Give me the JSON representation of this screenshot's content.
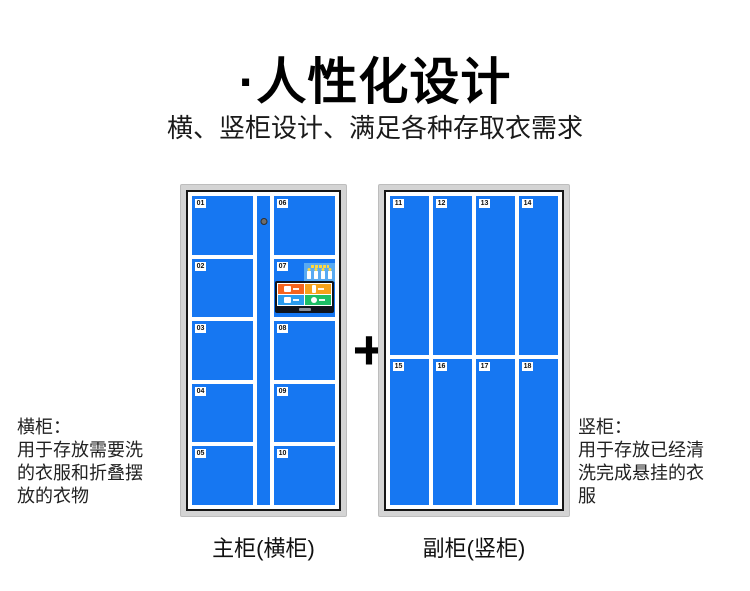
{
  "header": {
    "title": "·人性化设计",
    "subtitle": "横、竖柜设计、满足各种存取衣需求"
  },
  "plus_sign": "+",
  "main_cabinet": {
    "caption": "主柜(横柜)",
    "left_column_doors": [
      "01",
      "02",
      "03",
      "04",
      "05"
    ],
    "right_column_doors": [
      "06",
      "07",
      "08",
      "09",
      "10"
    ],
    "panel_door": "07"
  },
  "secondary_cabinet": {
    "caption": "副柜(竖柜)",
    "top_row_doors": [
      "11",
      "12",
      "13",
      "14"
    ],
    "bottom_row_doors": [
      "15",
      "16",
      "17",
      "18"
    ]
  },
  "annotations": {
    "left": {
      "heading": "横柜：",
      "lines": [
        "用于存放需要洗",
        "的衣服和折叠摆",
        "放的衣物"
      ]
    },
    "right": {
      "heading": "竖柜：",
      "lines": [
        "用于存放已经清",
        "洗完成悬挂的衣",
        "服"
      ]
    }
  },
  "icons": {
    "lock-icon": "dark round keyhole on center door column",
    "emergency-keys-icon": "four white key tags with yellow caps on blue panel",
    "gear-icon": "white gear dot on green screen tile",
    "plus-icon": "+"
  },
  "colors": {
    "door_blue": "#1677F2",
    "frame_gray": "#D4D4D4",
    "frame_border": "#161616",
    "key_panel_blue": "#58AAF2",
    "key_cap_yellow": "#FFD83D",
    "screen_bezel": "#10141C",
    "screen_tile_orange": "#F5641E",
    "screen_tile_amber": "#F7A21B",
    "screen_tile_blue": "#2A9CEE",
    "screen_tile_green": "#1DBE66"
  }
}
